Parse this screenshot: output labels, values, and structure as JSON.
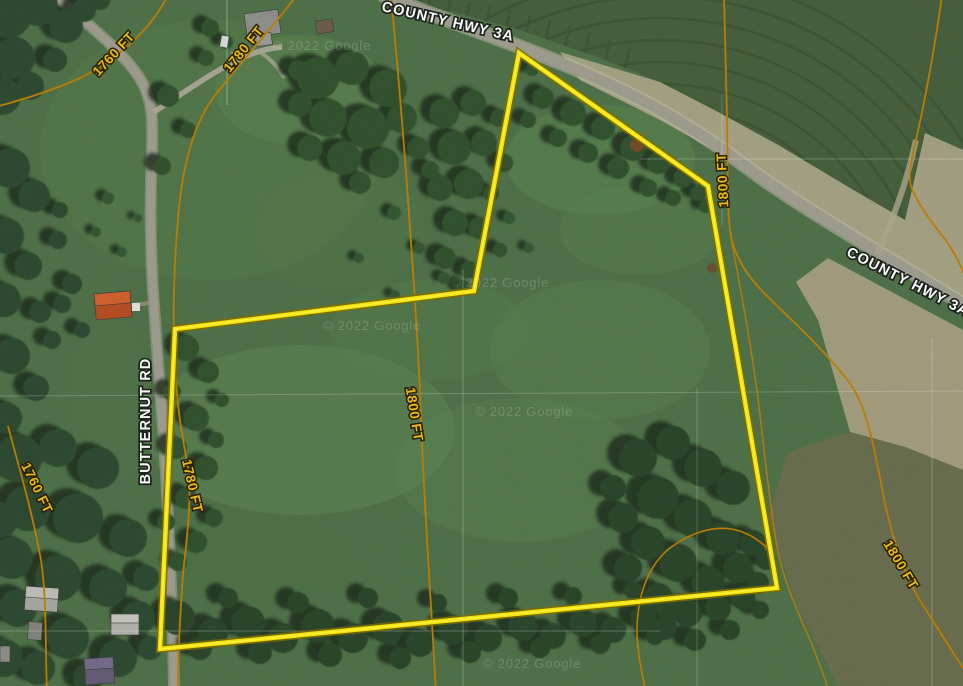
{
  "map": {
    "view": "satellite",
    "road_labels": {
      "hwy_top": "COUNTY HWY 3A",
      "hwy_right": "COUNTY HWY 3A",
      "butternut": "BUTTERNUT RD"
    },
    "contour_labels": {
      "tl_1760": "1760 FT",
      "tl_1780": "1780 FT",
      "right_1800": "1800 FT",
      "center_1800": "1800 FT",
      "left_1780": "1780 FT",
      "bl_1760": "1760 FT",
      "br_1800": "1800 FT"
    },
    "elevations_ft": [
      1760,
      1780,
      1800
    ],
    "watermark": "© 2022 Google",
    "colors": {
      "parcel_outline": "#ffe900",
      "contour_line": "#c07f00",
      "contour_label": "#f2c10e",
      "road_label_fill": "#ffffff"
    }
  }
}
